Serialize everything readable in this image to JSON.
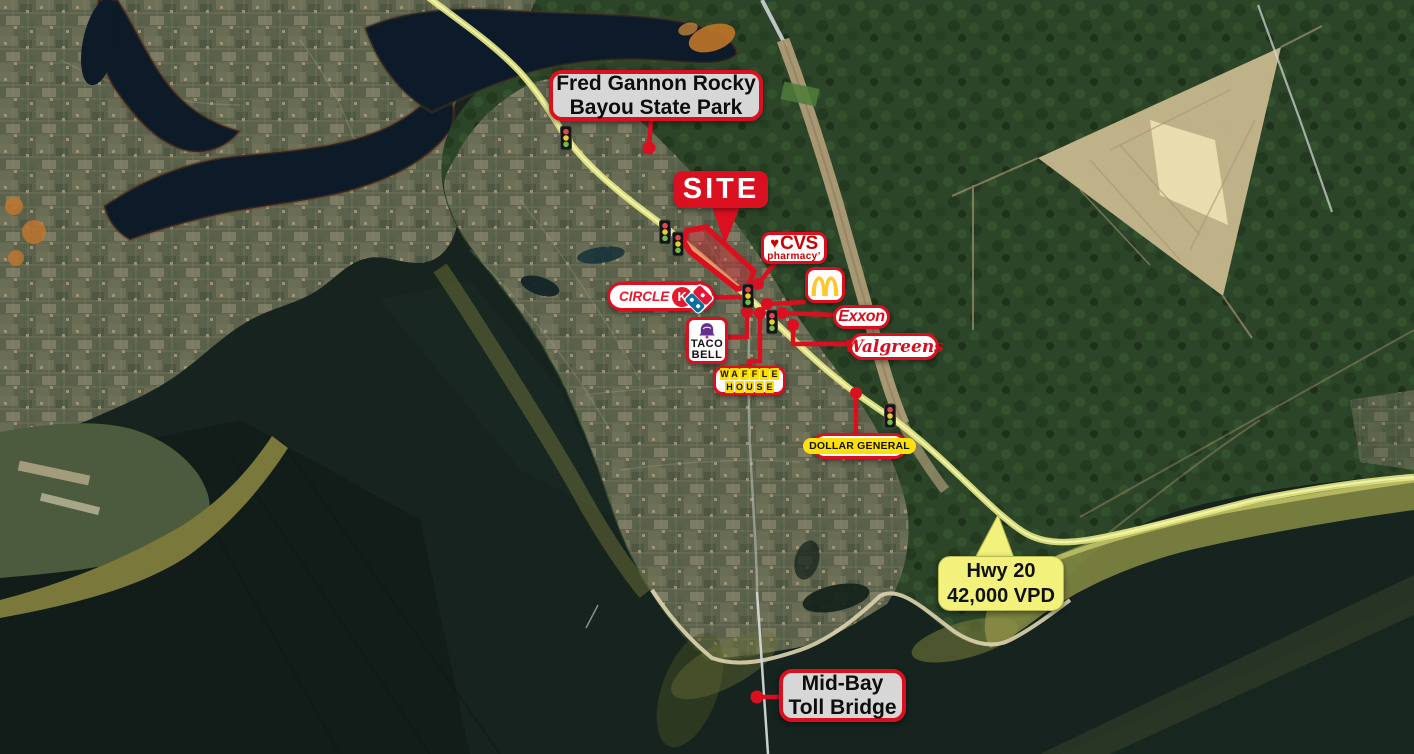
{
  "map": {
    "labels": {
      "state_park": {
        "line1": "Fred Gannon Rocky",
        "line2": "Bayou State Park"
      },
      "site": "SITE",
      "hwy20": {
        "line1": "Hwy 20",
        "line2": "42,000 VPD"
      },
      "mid_bay": {
        "line1": "Mid-Bay",
        "line2": "Toll Bridge"
      }
    },
    "retailers": {
      "cvs": {
        "heart": "♥",
        "name": "CVS",
        "sub": "pharmacy’"
      },
      "mcdonalds": {
        "icon": "golden-arches"
      },
      "circle_k": {
        "word": "CIRCLE",
        "k": "K"
      },
      "dominos": {
        "icon": "domino-tile"
      },
      "exxon": {
        "name": "Exxon"
      },
      "walgreens": {
        "name": "Walgreens"
      },
      "taco_bell": {
        "line1": "TACO",
        "line2": "BELL"
      },
      "waffle_house": {
        "row1": [
          "W",
          "A",
          "F",
          "F",
          "L",
          "E"
        ],
        "row2": [
          "H",
          "O",
          "U",
          "S",
          "E"
        ]
      },
      "dollar_general": {
        "name": "DOLLAR GENERAL"
      }
    },
    "colors": {
      "annotation_red": "#da1021",
      "label_gray": "#d7d7d7",
      "callout_yellow": "#f1f17c",
      "cvs_red": "#cc0000",
      "mcd_yellow": "#ffc72c",
      "dominos_blue": "#0a6ea0",
      "dominos_red": "#e31837",
      "taco_purple": "#65308f",
      "waffle_yellow": "#ffdd00",
      "dg_yellow": "#ffe10a",
      "highway_yellow": "#e9ec88",
      "traffic_red": "#e0474f",
      "traffic_yellow": "#e6cf2e",
      "traffic_green": "#6fb94e"
    }
  }
}
